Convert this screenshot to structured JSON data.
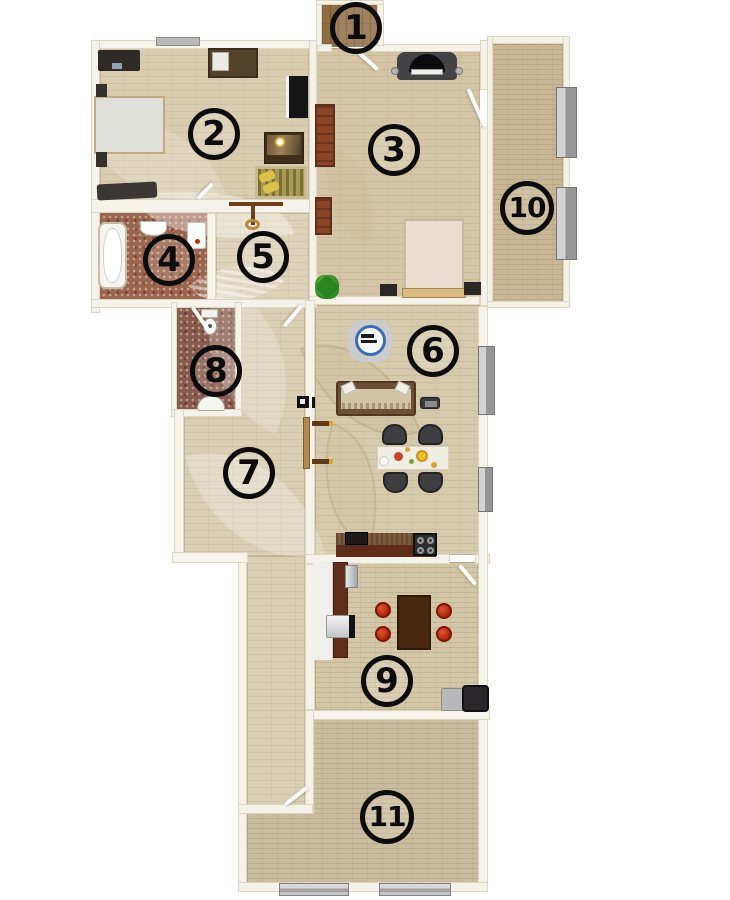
{
  "plan": {
    "type": "apartment-floor-plan",
    "badges": [
      "1",
      "2",
      "3",
      "4",
      "5",
      "6",
      "7",
      "8",
      "9",
      "10",
      "11"
    ],
    "colors": {
      "background": "#ffffff",
      "wall": "#f5f3e9",
      "wall_edge": "#dcd7c1",
      "floor_room2_bedroom": "#d9cdb1",
      "floor_room3": "#d3c5a5",
      "floor_room4_bath": "#9a644d",
      "floor_room5": "#ddd3bb",
      "floor_room6_living": "#d5caac",
      "floor_room7_hall": "#d8cfb5",
      "floor_room8_wc": "#875a4b",
      "floor_room9_dining": "#d4c7a7",
      "floor_room10_balcony": "#c8b795",
      "floor_room11": "#cabc9e",
      "floor_room1_entry": "#8e6d45",
      "chair_red": "#c5300f",
      "counter_brown": "#5f2e1d",
      "radiator_gray": "#a9a9a9",
      "plant_green": "#2e8b26",
      "badge_ink": "#0c0c0c"
    },
    "icons": [
      "bed-icon",
      "desk-icon",
      "wardrobe-icon",
      "dresser-icon",
      "crib-icon",
      "piano-icon",
      "bookshelf-icon",
      "bathtub-icon",
      "sink-icon",
      "toilet-icon",
      "washing-machine-icon",
      "coat-rack-icon",
      "clock-icon",
      "sofa-icon",
      "tv-icon",
      "dining-table-icon",
      "chair-icon",
      "stove-icon",
      "kitchen-counter-icon",
      "fridge-icon",
      "radiator-icon",
      "window-icon",
      "plant-icon",
      "door-swing-icon",
      "nightstand-icon"
    ]
  }
}
